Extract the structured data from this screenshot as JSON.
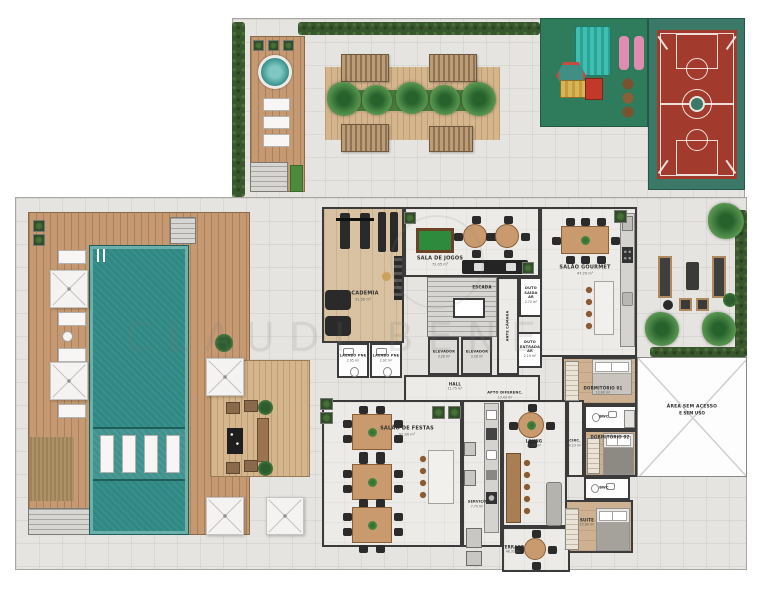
{
  "watermark": {
    "text": "CLAUDI BENE"
  },
  "rooms": {
    "academia": {
      "name": "ACADEMIA",
      "area": "31.50 m²"
    },
    "sala_de_jogos": {
      "name": "SALA DE JOGOS",
      "area": "72.05 m²"
    },
    "escada": {
      "name": "ESCADA"
    },
    "elevador_1": {
      "name": "ELEVADOR",
      "area": "3.28 m²"
    },
    "elevador_2": {
      "name": "ELEVADOR",
      "area": "3.28 m²"
    },
    "ante_camara": {
      "name": "ANTE CÂMARA"
    },
    "duto_saida_ar": {
      "name": "DUTO SAÍDA AR",
      "area": "2.70 m²"
    },
    "duto_entrada_ar": {
      "name": "DUTO ENTRADA AR",
      "area": "2.19 m²"
    },
    "lavabo_pne_1": {
      "name": "LAVABO PNE",
      "area": "2.95 m²"
    },
    "lavabo_pne_2": {
      "name": "LAVABO PNE",
      "area": "2.92 m²"
    },
    "hall": {
      "name": "HALL",
      "area": "11.75 m²"
    },
    "apto_diferenc": {
      "name": "APTO DIFERENC.",
      "area": "13.43 m²"
    },
    "salao_gourmet": {
      "name": "SALÃO GOURMET",
      "area": "47.70 m²"
    },
    "dormitorio_01": {
      "name": "DORMITÓRIO 01",
      "area": "12.60 m²"
    },
    "bwc_1": {
      "name": "BWC",
      "area": "3.60 m²"
    },
    "dormitorio_02": {
      "name": "DORMITÓRIO 02",
      "area": "12.00 m²"
    },
    "bwc_2": {
      "name": "BWC",
      "area": "3.60 m²"
    },
    "suite": {
      "name": "SUITE",
      "area": "15.60 m²"
    },
    "area_sem_acesso": {
      "line1": "ÁREA SEM ACESSO",
      "line2": "E SEM USO"
    },
    "salao_de_festas": {
      "name": "SALÃO DE FESTAS",
      "area": "91.30 m²"
    },
    "servico": {
      "name": "SERVIÇO",
      "area": "7.70 m²"
    },
    "living": {
      "name": "LIVING",
      "area": "27.76 m²"
    },
    "circ": {
      "name": "CIRC.",
      "area": "4.23 m²"
    },
    "terraco": {
      "name": "TERRAÇO",
      "area": "48.32 m²"
    }
  },
  "colors": {
    "pool_water": "#2f8884",
    "deck_wood": "#c59a73",
    "hedge": "#39572f",
    "court_red": "#a23a2e",
    "court_green": "#3c7868",
    "playground_green": "#2e7c5b",
    "wall": "#3b3b3b",
    "tile": "#e6e4e0"
  }
}
